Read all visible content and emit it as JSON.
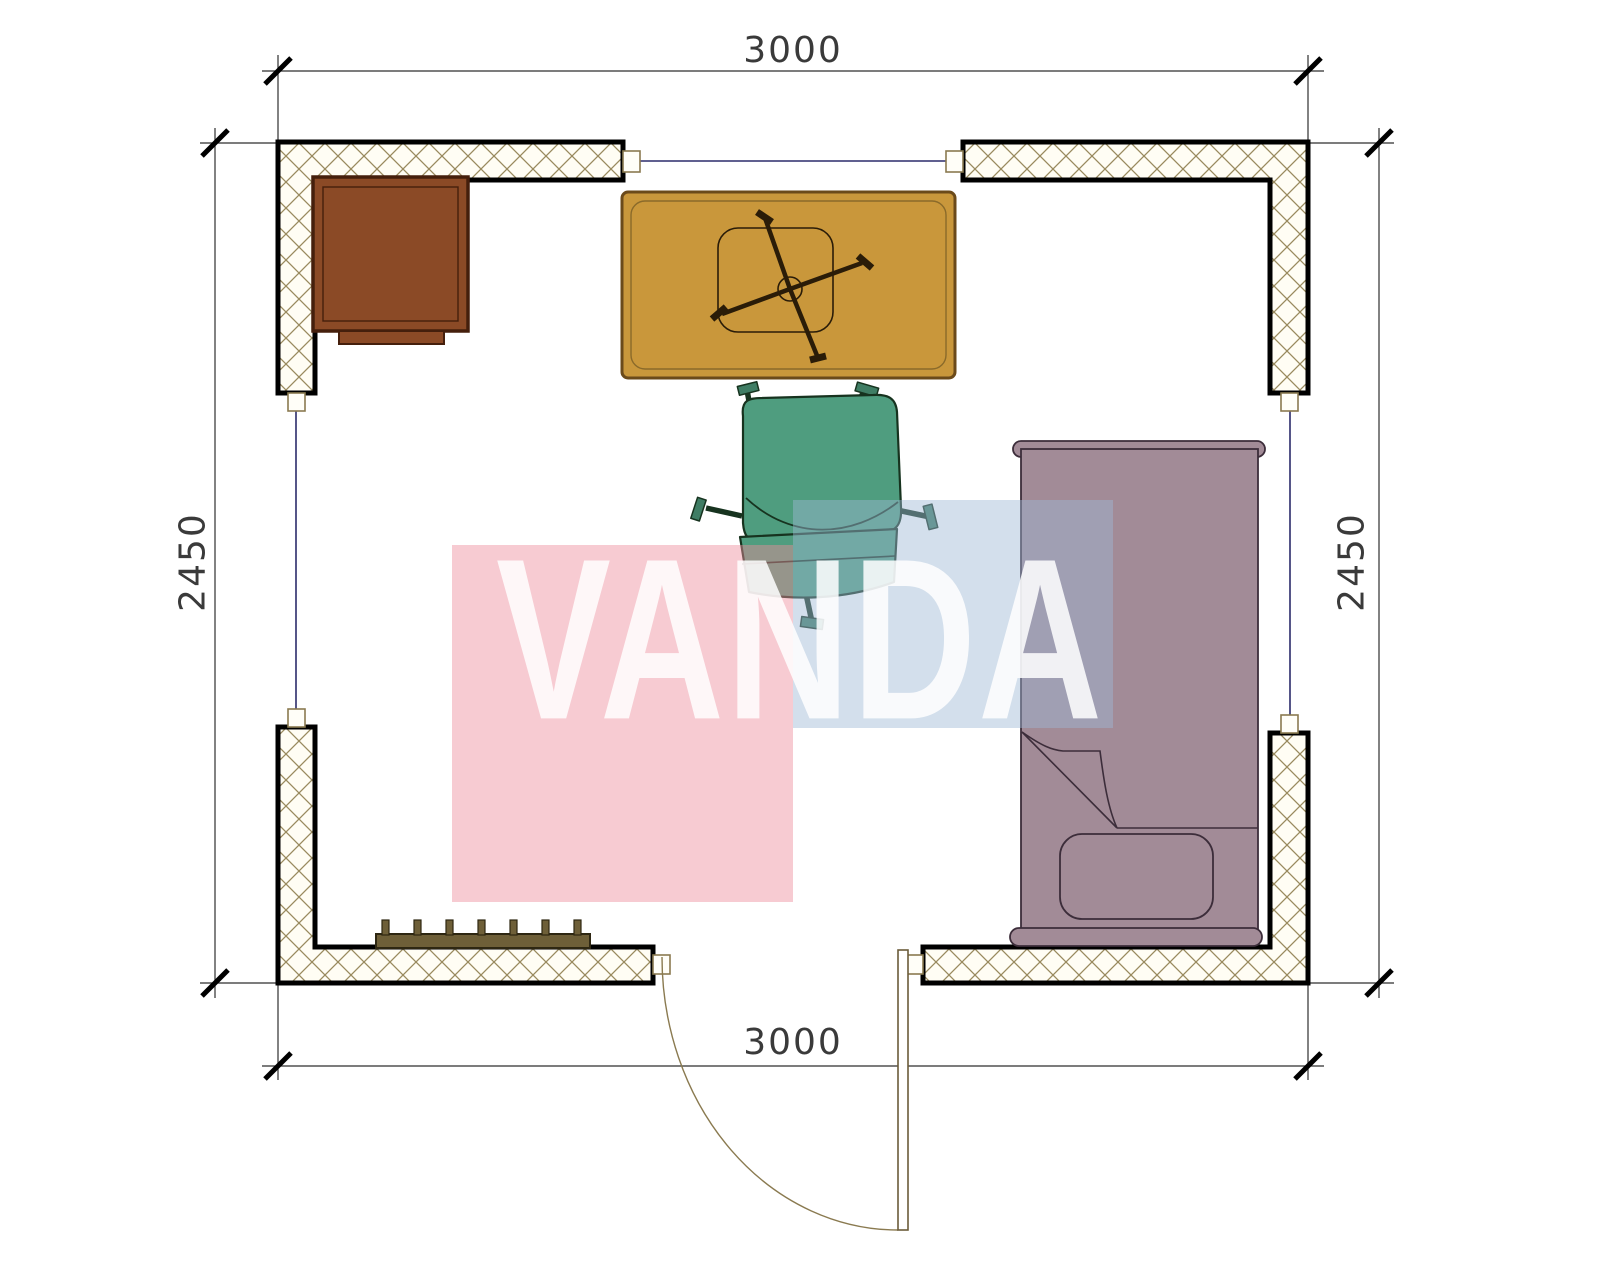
{
  "drawing": {
    "type": "floor-plan",
    "watermark_text": "VANDA",
    "dimensions": {
      "top": "3000",
      "bottom": "3000",
      "left": "2450",
      "right": "2450"
    },
    "objects": [
      "corner-cabinet",
      "desk-table",
      "task-chair-base",
      "office-chair",
      "bed-with-pillow",
      "radiator",
      "door-swing",
      "window-openings"
    ],
    "colors": {
      "wall_hatch": "#998a5e",
      "wall_fill": "#fffdf4",
      "wall_outline": "#000000",
      "window_line": "#2b2b6b",
      "cabinet": "#8b4a26",
      "table": "#c9973b",
      "chair": "#4f9d7f",
      "bed": "#a28b97",
      "radiator": "#6e5f38",
      "door": "#8a7a50",
      "watermark_pink": "#f7cbd2",
      "watermark_blue": "#d3dfec",
      "dimension_text": "#3a3a3a"
    }
  }
}
